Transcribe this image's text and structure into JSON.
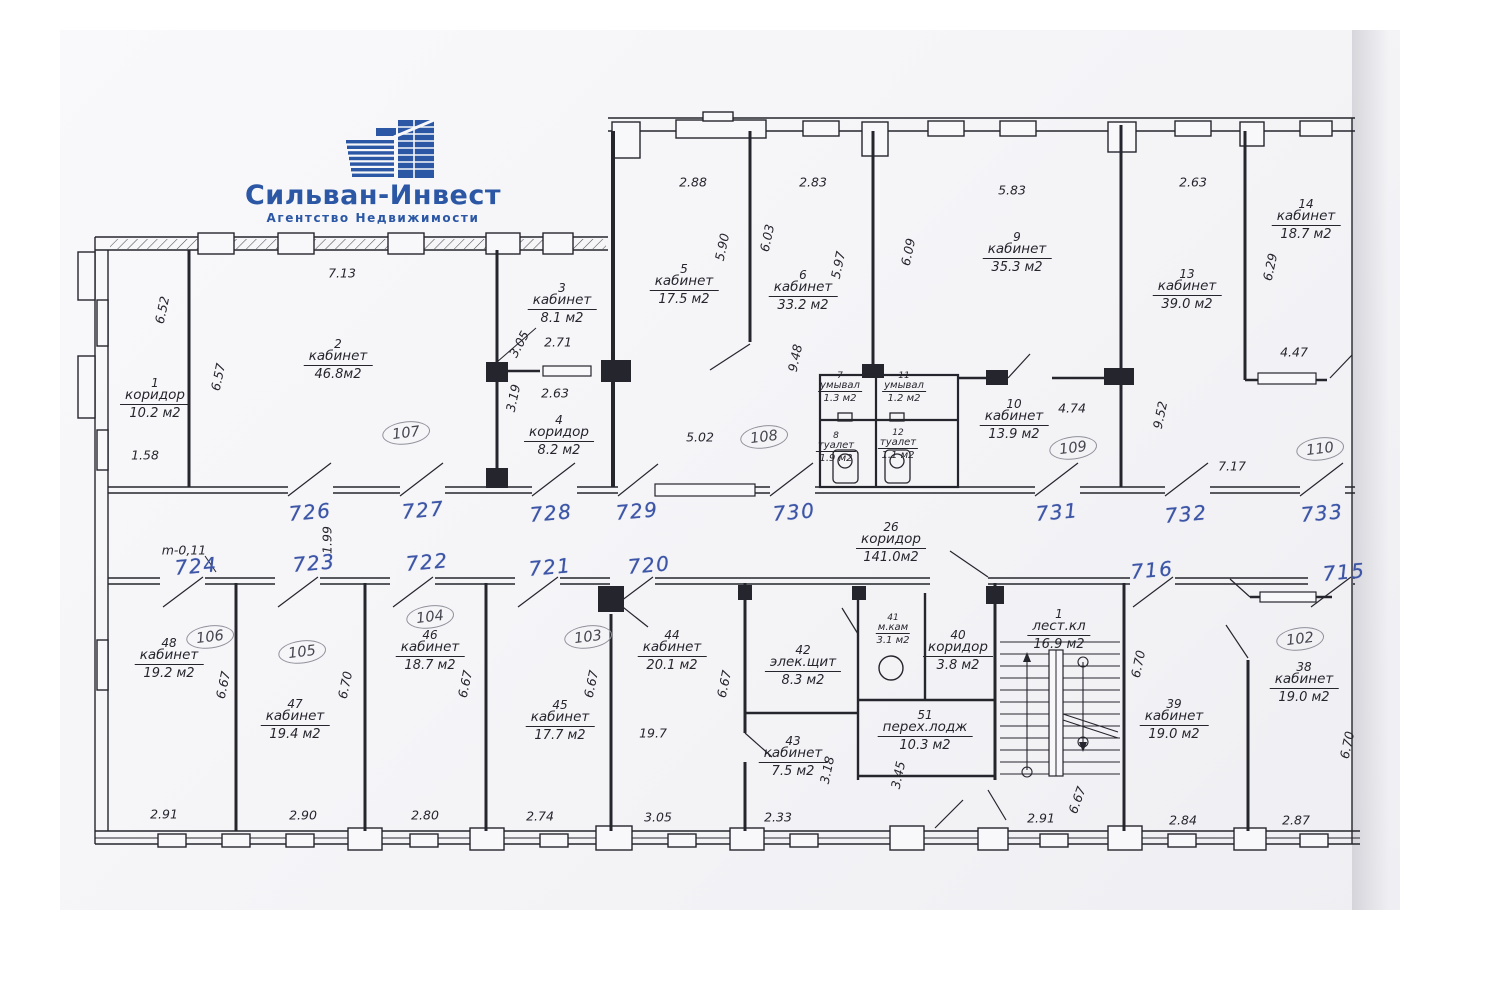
{
  "logo": {
    "title": "Сильван-Инвест",
    "subtitle": "Агентство Недвижимости"
  },
  "colors": {
    "ink": "#25252d",
    "pen_blue": "#3c55a6",
    "pencil_gray": "#90909b",
    "logo_blue": "#2b57a5",
    "paper": "#f6f6f9"
  },
  "plan": {
    "rooms": [
      {
        "number": "1",
        "name": "коридор",
        "area": "10.2 м2",
        "x": 155,
        "y": 377
      },
      {
        "number": "2",
        "name": "кабинет",
        "area": "46.8м2",
        "x": 338,
        "y": 338
      },
      {
        "number": "3",
        "name": "кабинет",
        "area": "8.1  м2",
        "x": 562,
        "y": 282
      },
      {
        "number": "4",
        "name": "коридор",
        "area": "8.2 м2",
        "x": 559,
        "y": 414
      },
      {
        "number": "5",
        "name": "кабинет",
        "area": "17.5 м2",
        "x": 684,
        "y": 263
      },
      {
        "number": "6",
        "name": "кабинет",
        "area": "33.2 м2",
        "x": 803,
        "y": 269
      },
      {
        "number": "7",
        "name": "умывал",
        "area": "1.3 м2",
        "x": 840,
        "y": 372,
        "small": true
      },
      {
        "number": "11",
        "name": "умывал",
        "area": "1.2 м2",
        "x": 904,
        "y": 372,
        "small": true
      },
      {
        "number": "8",
        "name": "туалет",
        "area": "1.9 м2",
        "x": 836,
        "y": 432,
        "small": true
      },
      {
        "number": "12",
        "name": "туалет",
        "area": "1.1 м2",
        "x": 898,
        "y": 429,
        "small": true
      },
      {
        "number": "9",
        "name": "кабинет",
        "area": "35.3 м2",
        "x": 1017,
        "y": 231
      },
      {
        "number": "10",
        "name": "кабинет",
        "area": "13.9 м2",
        "x": 1014,
        "y": 398
      },
      {
        "number": "13",
        "name": "кабинет",
        "area": "39.0 м2",
        "x": 1187,
        "y": 268
      },
      {
        "number": "14",
        "name": "кабинет",
        "area": "18.7 м2",
        "x": 1306,
        "y": 198
      },
      {
        "number": "26",
        "name": "коридор",
        "area": "141.0м2",
        "x": 891,
        "y": 521
      },
      {
        "number": "38",
        "name": "кабинет",
        "area": "19.0 м2",
        "x": 1304,
        "y": 661
      },
      {
        "number": "39",
        "name": "кабинет",
        "area": "19.0 м2",
        "x": 1174,
        "y": 698
      },
      {
        "number": "40",
        "name": "коридор",
        "area": "3.8 м2",
        "x": 958,
        "y": 629
      },
      {
        "number": "41",
        "name": "м.кам",
        "area": "3.1 м2",
        "x": 893,
        "y": 614,
        "small": true
      },
      {
        "number": "42",
        "name": "элек.щит",
        "area": "8.3 м2",
        "x": 803,
        "y": 644
      },
      {
        "number": "43",
        "name": "кабинет",
        "area": "7.5 м2",
        "x": 793,
        "y": 735
      },
      {
        "number": "44",
        "name": "кабинет",
        "area": "20.1 м2",
        "x": 672,
        "y": 629
      },
      {
        "number": "45",
        "name": "кабинет",
        "area": "17.7 м2",
        "x": 560,
        "y": 699
      },
      {
        "number": "46",
        "name": "кабинет",
        "area": "18.7 м2",
        "x": 430,
        "y": 629
      },
      {
        "number": "47",
        "name": "кабинет",
        "area": "19.4 м2",
        "x": 295,
        "y": 698
      },
      {
        "number": "48",
        "name": "кабинет",
        "area": "19.2 м2",
        "x": 169,
        "y": 637
      },
      {
        "number": "51",
        "name": "перех.лодж",
        "area": "10.3 м2",
        "x": 925,
        "y": 709
      },
      {
        "number": "1",
        "name": "лест.кл",
        "area": "16.9 м2",
        "x": 1059,
        "y": 608
      }
    ],
    "dimensions": [
      {
        "t": "7.13",
        "x": 342,
        "y": 273
      },
      {
        "t": "6.52",
        "x": 162,
        "y": 310,
        "r": -78
      },
      {
        "t": "6.57",
        "x": 218,
        "y": 377,
        "r": -78
      },
      {
        "t": "1.58",
        "x": 145,
        "y": 455
      },
      {
        "t": "2.88",
        "x": 693,
        "y": 182
      },
      {
        "t": "2.83",
        "x": 813,
        "y": 182
      },
      {
        "t": "5.83",
        "x": 1012,
        "y": 190
      },
      {
        "t": "2.63",
        "x": 1193,
        "y": 182
      },
      {
        "t": "5.90",
        "x": 722,
        "y": 247,
        "r": -78
      },
      {
        "t": "6.03",
        "x": 767,
        "y": 238,
        "r": -78
      },
      {
        "t": "5.97",
        "x": 838,
        "y": 265,
        "r": -78
      },
      {
        "t": "6.09",
        "x": 908,
        "y": 252,
        "r": -78
      },
      {
        "t": "9.48",
        "x": 795,
        "y": 358,
        "r": -78
      },
      {
        "t": "2.71",
        "x": 558,
        "y": 342
      },
      {
        "t": "3.05",
        "x": 519,
        "y": 344,
        "r": -62
      },
      {
        "t": "3.19",
        "x": 513,
        "y": 398,
        "r": -78
      },
      {
        "t": "2.63",
        "x": 555,
        "y": 393
      },
      {
        "t": "5.02",
        "x": 700,
        "y": 437
      },
      {
        "t": "9.52",
        "x": 1160,
        "y": 415,
        "r": -78
      },
      {
        "t": "4.74",
        "x": 1072,
        "y": 408
      },
      {
        "t": "7.17",
        "x": 1232,
        "y": 466
      },
      {
        "t": "6.29",
        "x": 1270,
        "y": 267,
        "r": -78
      },
      {
        "t": "4.47",
        "x": 1294,
        "y": 352
      },
      {
        "t": "1.99",
        "x": 327,
        "y": 540,
        "r": -90
      },
      {
        "t": "m-0,11",
        "x": 184,
        "y": 550
      },
      {
        "t": "2.91",
        "x": 164,
        "y": 814
      },
      {
        "t": "2.90",
        "x": 303,
        "y": 815
      },
      {
        "t": "2.80",
        "x": 425,
        "y": 815
      },
      {
        "t": "2.74",
        "x": 540,
        "y": 816
      },
      {
        "t": "3.05",
        "x": 658,
        "y": 817
      },
      {
        "t": "2.33",
        "x": 778,
        "y": 817
      },
      {
        "t": "2.91",
        "x": 1041,
        "y": 818
      },
      {
        "t": "2.84",
        "x": 1183,
        "y": 820
      },
      {
        "t": "2.87",
        "x": 1296,
        "y": 820
      },
      {
        "t": "6.67",
        "x": 223,
        "y": 685,
        "r": -78
      },
      {
        "t": "6.70",
        "x": 345,
        "y": 685,
        "r": -78
      },
      {
        "t": "6.67",
        "x": 465,
        "y": 684,
        "r": -78
      },
      {
        "t": "6.67",
        "x": 591,
        "y": 684,
        "r": -78
      },
      {
        "t": "6.67",
        "x": 724,
        "y": 684,
        "r": -78
      },
      {
        "t": "19.7",
        "x": 653,
        "y": 733
      },
      {
        "t": "3.18",
        "x": 827,
        "y": 770,
        "r": -78
      },
      {
        "t": "3.45",
        "x": 898,
        "y": 775,
        "r": -78
      },
      {
        "t": "6.70",
        "x": 1138,
        "y": 664,
        "r": -78
      },
      {
        "t": "6.67",
        "x": 1077,
        "y": 800,
        "r": -70
      },
      {
        "t": "6.70",
        "x": 1347,
        "y": 745,
        "r": -78
      }
    ],
    "door_numbers": [
      {
        "t": "726",
        "x": 310,
        "y": 512
      },
      {
        "t": "727",
        "x": 423,
        "y": 510
      },
      {
        "t": "728",
        "x": 551,
        "y": 513
      },
      {
        "t": "729",
        "x": 637,
        "y": 511
      },
      {
        "t": "730",
        "x": 794,
        "y": 512
      },
      {
        "t": "731",
        "x": 1057,
        "y": 512
      },
      {
        "t": "732",
        "x": 1186,
        "y": 514
      },
      {
        "t": "733",
        "x": 1322,
        "y": 513
      },
      {
        "t": "724",
        "x": 196,
        "y": 566
      },
      {
        "t": "723",
        "x": 314,
        "y": 563
      },
      {
        "t": "722",
        "x": 427,
        "y": 562
      },
      {
        "t": "721",
        "x": 550,
        "y": 567
      },
      {
        "t": "720",
        "x": 649,
        "y": 565
      },
      {
        "t": "716",
        "x": 1152,
        "y": 570
      },
      {
        "t": "715",
        "x": 1344,
        "y": 572
      }
    ],
    "circled_numbers": [
      {
        "t": "107",
        "x": 406,
        "y": 433
      },
      {
        "t": "108",
        "x": 764,
        "y": 437
      },
      {
        "t": "109",
        "x": 1073,
        "y": 448
      },
      {
        "t": "110",
        "x": 1320,
        "y": 449
      },
      {
        "t": "106",
        "x": 210,
        "y": 637
      },
      {
        "t": "105",
        "x": 302,
        "y": 652
      },
      {
        "t": "104",
        "x": 430,
        "y": 617
      },
      {
        "t": "103",
        "x": 588,
        "y": 637
      },
      {
        "t": "102",
        "x": 1300,
        "y": 639
      }
    ]
  }
}
